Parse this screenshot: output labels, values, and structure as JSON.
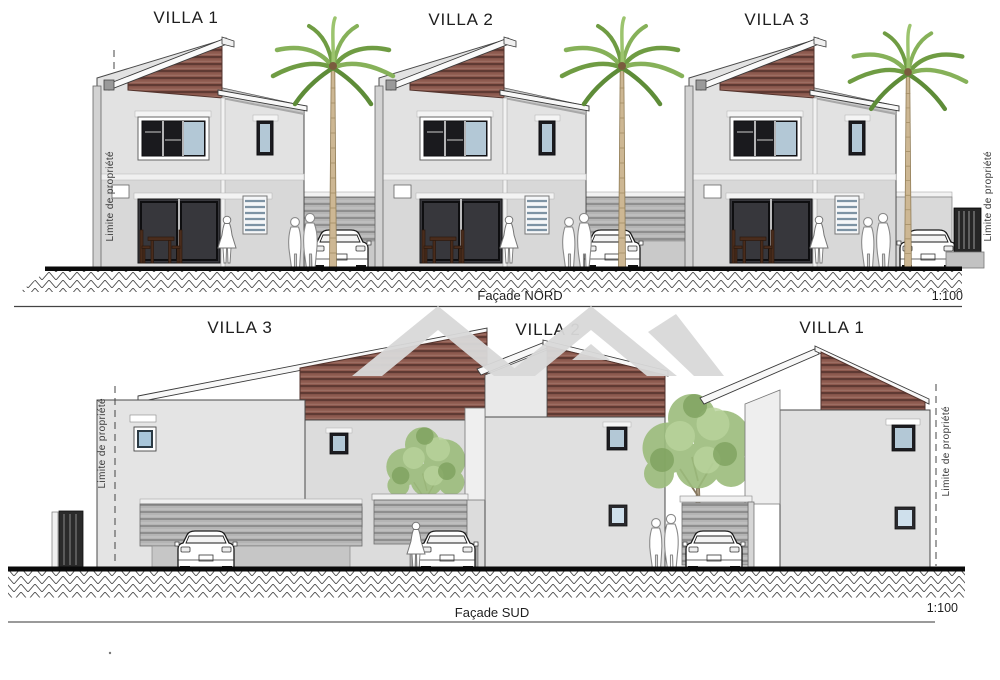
{
  "north_view": {
    "villas": [
      "VILLA 1",
      "VILLA 2",
      "VILLA 3"
    ],
    "caption": "Façade NORD",
    "scale": "1:100",
    "property_limit_left": "Limite de propriété",
    "property_limit_right": "Limite de propriété"
  },
  "south_view": {
    "villas": [
      "VILLA 3",
      "VILLA 2",
      "VILLA 1"
    ],
    "caption": "Façade SUD",
    "scale": "1:100",
    "property_limit_left": "Limite de propriété",
    "property_limit_right": "Limite de propriété"
  },
  "colors": {
    "roof_cladding": "#8d5a4f",
    "wall_light": "#e2e2e2",
    "wall_mid": "#d8d8d8",
    "window_glass": "#b3c8d6",
    "watermark": "#d9d9d9",
    "ground_line": "#0a0a0a"
  }
}
